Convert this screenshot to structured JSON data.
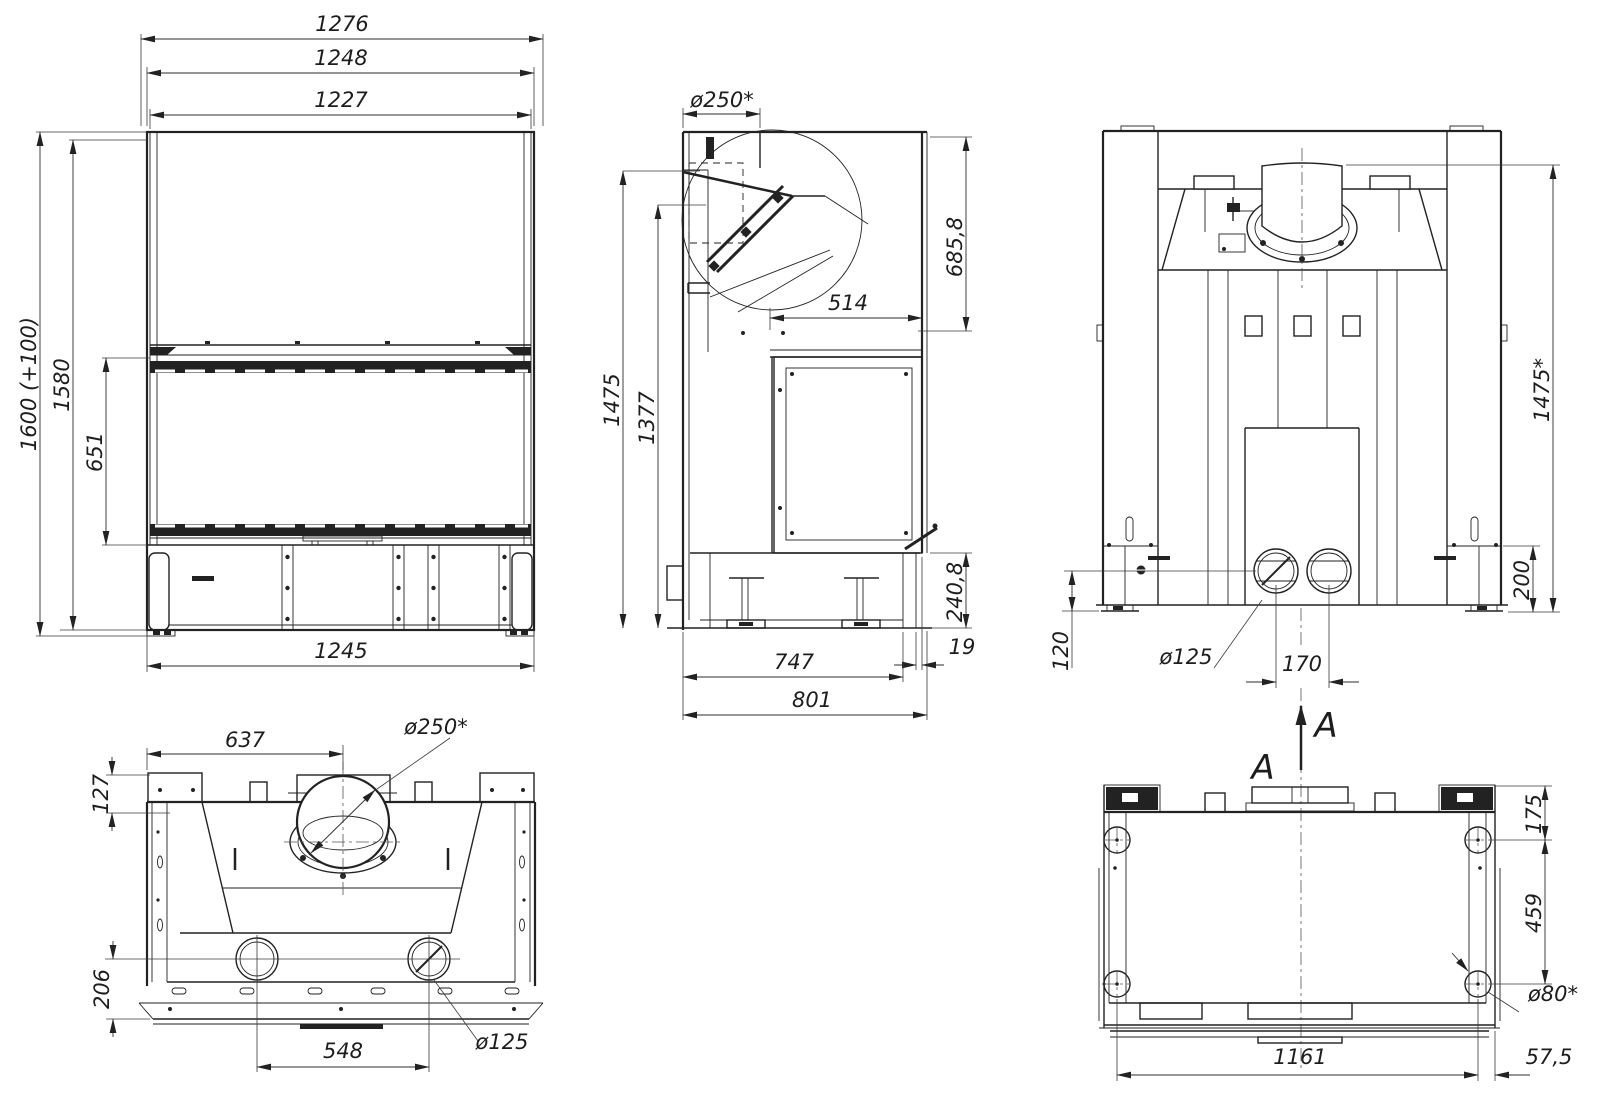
{
  "section_marker": {
    "letter_upper": "A",
    "letter_lower": "A"
  },
  "views": {
    "front": {
      "dims": {
        "overall_width": "1276",
        "mid_width": "1248",
        "glass_width": "1227",
        "base_width": "1245",
        "overall_height": "1600 (+100)",
        "body_height": "1580",
        "glass_height": "651"
      }
    },
    "side": {
      "dims": {
        "flue_diameter": "ø250*",
        "back_top_height": "685,8",
        "top_depth": "514",
        "height_total": "1475",
        "height_inner": "1377",
        "base_height": "240,8",
        "rear_offset": "19",
        "depth_base": "747",
        "depth_overall": "801"
      }
    },
    "rear": {
      "dims": {
        "height_total": "1475*",
        "base_height": "200",
        "inlet_center_height": "120",
        "inlet_diameter": "ø125",
        "inlet_spacing": "170"
      }
    },
    "top": {
      "dims": {
        "flue_center_offset": "637",
        "flue_diameter": "ø250*",
        "front_depth": "127",
        "rear_depth": "206",
        "inlet_spacing": "548",
        "inlet_diameter": "ø125"
      }
    },
    "bottom": {
      "dims": {
        "foot_inset_depth": "175",
        "foot_span_depth": "459",
        "foot_diameter": "ø80*",
        "foot_span_width": "1161",
        "foot_inset_width": "57,5"
      }
    }
  }
}
